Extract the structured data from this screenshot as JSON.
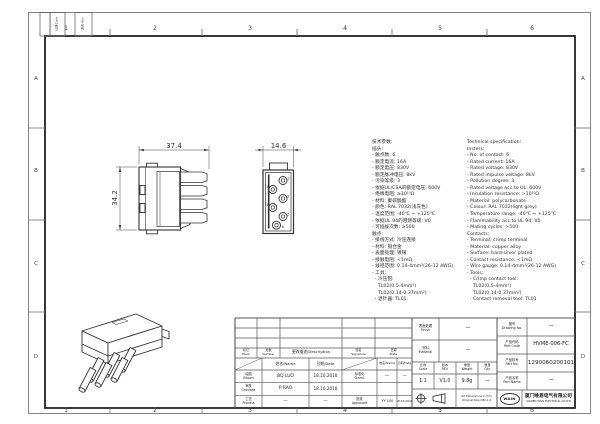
{
  "frame": {
    "zones_h": [
      "1",
      "2",
      "3",
      "4",
      "5",
      "6"
    ],
    "zones_v": [
      "A",
      "B",
      "C",
      "D"
    ],
    "rev_strip_box1": "日期/Date",
    "rev_strip_box2": "更改 Rev"
  },
  "views": {
    "side_view": {
      "width_dim": "37.4",
      "height_dim": "34.2"
    },
    "face_view": {
      "width_dim": "14.6",
      "contacts": [
        "1",
        "2",
        "3",
        "4",
        "5",
        "6"
      ]
    }
  },
  "specs": {
    "cn": [
      "技术参数:",
      "插头:",
      "- 触点数: 6",
      "- 额定电流: 16A",
      "- 额定电压: 830V",
      "- 额定脉冲电压: 8kV",
      "- 污染等级: 3",
      "- 依据UL/CSA的额定电压: 600V",
      "- 绝缘电阻: ≥10¹⁰Ω",
      "- 材料: 聚碳酸酯",
      "- 颜色: RAL 7032(浅灰色)",
      "- 温度范围: -40℃ ~ +125℃",
      "- 依据UL 94的阻燃等级: V0",
      "- 可插拔次数: ≥500",
      "触点:",
      "- 接线方式: 冷压连接",
      "- 材料: 铜合金",
      "- 表面处理: 镀银",
      "- 接触电阻: <1mΩ",
      "- 线径范围: 0.14-4mm²(26-12 AWG)",
      "- 工具:",
      "  · 冷压钳:",
      "    TL02(0.5-4mm²)",
      "    TL02(0.14-0.37mm²)",
      "  · 退针器: TL01"
    ],
    "en": [
      "Technical specification:",
      "Insters:",
      "- No. of contact: 6",
      "- Rated current: 16A",
      "- Rated voltage: 830V",
      "- Rated impulse voltage: 8kV",
      "- Pollution degree: 3",
      "- Rated voltage acc.to UL: 600V",
      "- Insulation resistance: >10¹⁰Ω",
      "- Material: polycarbonate",
      "- Colour: RAL 7032(light grey)",
      "- Temperature range: -40℃ ~ +125℃",
      "- Flammability acc.to UL 94: V0",
      "- Mating cycles: >500",
      "Contacts:",
      "- Terminal: crimp terminal",
      "- Material: copper alloy",
      "- Surface: hard-silver plated",
      "- Contact resistance: <1mΩ",
      "- Wire gauge: 0.14-4mm²(26-12 AWG)",
      "- Tools:",
      "  · Crimp contact tool:",
      "    TL02(0.5-4mm²)",
      "    TL02(0.14-0.37mm²)",
      "  · Contact removal tool: TL01"
    ]
  },
  "titleblock": {
    "rev_table": {
      "mark": "标记\nMark",
      "number": "处数\nNumber",
      "description": "更改描述/Description",
      "signature": "签名\nSignature",
      "date": "日期\nDate"
    },
    "sign_table": {
      "name_header": "姓名/Name",
      "date_header": "日期/Date",
      "drawn_label": "绘图\nDrawn",
      "drawn_name": "BQ LUO",
      "drawn_date": "18.10.2010",
      "checked_label": "审核\nChecked",
      "checked_name": "P RAO",
      "checked_date": "18.10.2010",
      "process_label": "工艺\nProcess",
      "process_name": "—",
      "process_date": "—",
      "stand_label": "标准化\nStand.",
      "stand_name": "—",
      "stand_date": "—",
      "approved_label": "批准\nApproved",
      "approved_name": "YY LIN",
      "approved_date": "18.10.2010"
    },
    "finish_label": "表面处理\nFinish",
    "finish_value": "—",
    "material_label": "材料\nMaterial",
    "material_value": "—",
    "scale_label": "比例\nScale",
    "scale_value": "1:1",
    "rev_label": "版本\nREV.",
    "rev_value": "V1.0",
    "weight_label": "重量\nWeight",
    "weight_value": "9.8g",
    "qty_label": "数量\nQty.",
    "qty_value": "—",
    "note": "All Dimensions in mm\nOriginal Size DIN A 4",
    "drawing_no_label": "图号\nDrawing No.",
    "drawing_no_value": "—",
    "part_code_label": "产品代码\nPart Code",
    "part_code_value": "HVME-006-FC",
    "part_no_label": "产品料号\nPart No.",
    "part_no_value": "1290060200101",
    "part_name_label": "产品名称\nPart Name",
    "part_name_value": "—",
    "logo": "WAIN",
    "company_cn": "厦门唯恩电气有限公司",
    "company_en": "XIAMEN WAIN ELECTRICAL CO.LTD"
  }
}
